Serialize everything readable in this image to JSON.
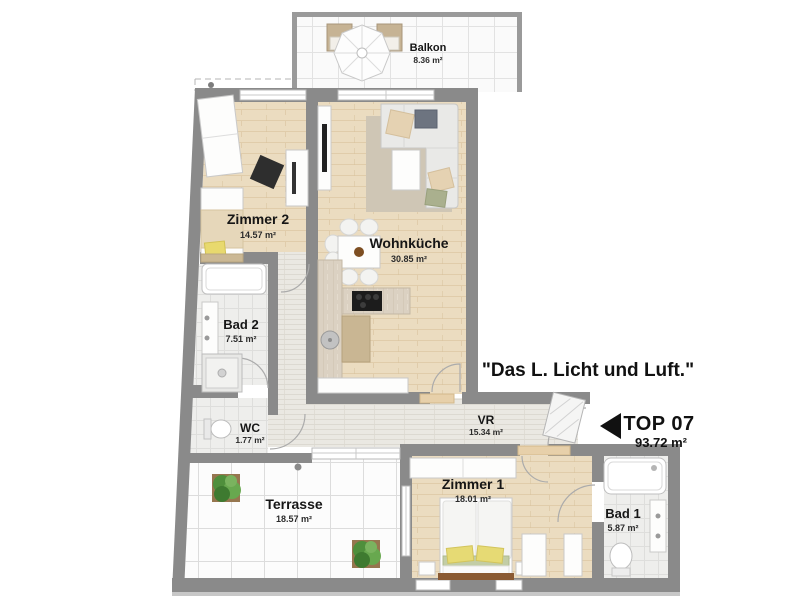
{
  "plan": {
    "quote": "\"Das L. Licht und Luft.\"",
    "unit": {
      "title": "TOP 07",
      "area": "93.72 m²"
    },
    "rooms": {
      "balkon": {
        "label": "Balkon",
        "area": "8.36 m²"
      },
      "zimmer2": {
        "label": "Zimmer 2",
        "area": "14.57 m²"
      },
      "wohnkueche": {
        "label": "Wohnküche",
        "area": "30.85 m²"
      },
      "bad2": {
        "label": "Bad 2",
        "area": "7.51 m²"
      },
      "wc": {
        "label": "WC",
        "area": "1.77 m²"
      },
      "vr": {
        "label": "VR",
        "area": "15.34 m²"
      },
      "terrasse": {
        "label": "Terrasse",
        "area": "18.57 m²"
      },
      "zimmer1": {
        "label": "Zimmer 1",
        "area": "18.01 m²"
      },
      "bad1": {
        "label": "Bad 1",
        "area": "5.87 m²"
      }
    },
    "colors": {
      "wall": "#8a8a8a",
      "wood": "#ebdcc0",
      "tile": "#eeeeec",
      "plant_green": "#4f8f3c",
      "text": "#111111"
    }
  }
}
